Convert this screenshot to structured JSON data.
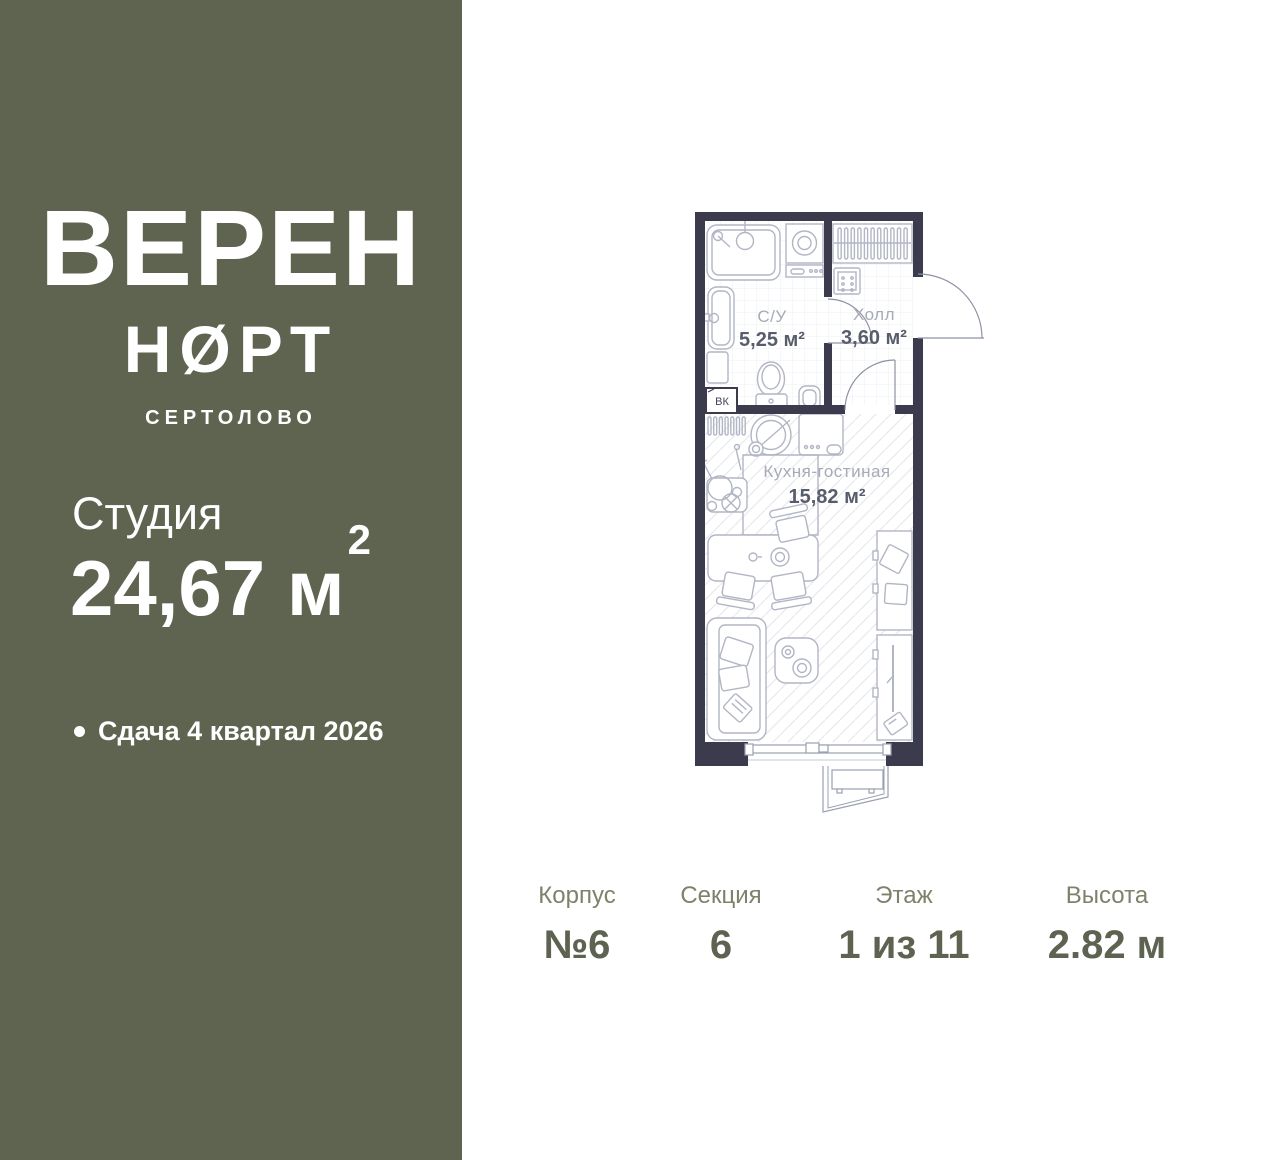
{
  "sidebar": {
    "brand_line1": "ВЕРЕН",
    "brand_line2": "НØРТ",
    "brand_city": "СЕРТОЛОВО",
    "unit_type": "Студия",
    "area_value": "24,67 м",
    "area_sup": "2",
    "delivery_note": "Сдача 4 квартал 2026",
    "bg_color": "#5f6450",
    "text_color": "#ffffff"
  },
  "floor_plan": {
    "wall_color": "#3b3b4d",
    "furniture_line_color": "#b2b6c4",
    "room_name_color": "#a6abb6",
    "room_area_color": "#585d6c",
    "rooms": [
      {
        "name": "С/У",
        "area": "5,25 м²"
      },
      {
        "name": "Холл",
        "area": "3,60 м²"
      },
      {
        "name": "Кухня-гостиная",
        "area": "15,82 м²"
      }
    ],
    "vent_label": "ВК"
  },
  "info_bar": {
    "label_color": "#7d826a",
    "value_color": "#5d6251",
    "items": [
      {
        "label": "Корпус",
        "value": "№6"
      },
      {
        "label": "Секция",
        "value": "6"
      },
      {
        "label": "Этаж",
        "value": "1 из 11"
      },
      {
        "label": "Высота",
        "value": "2.82 м"
      }
    ]
  }
}
